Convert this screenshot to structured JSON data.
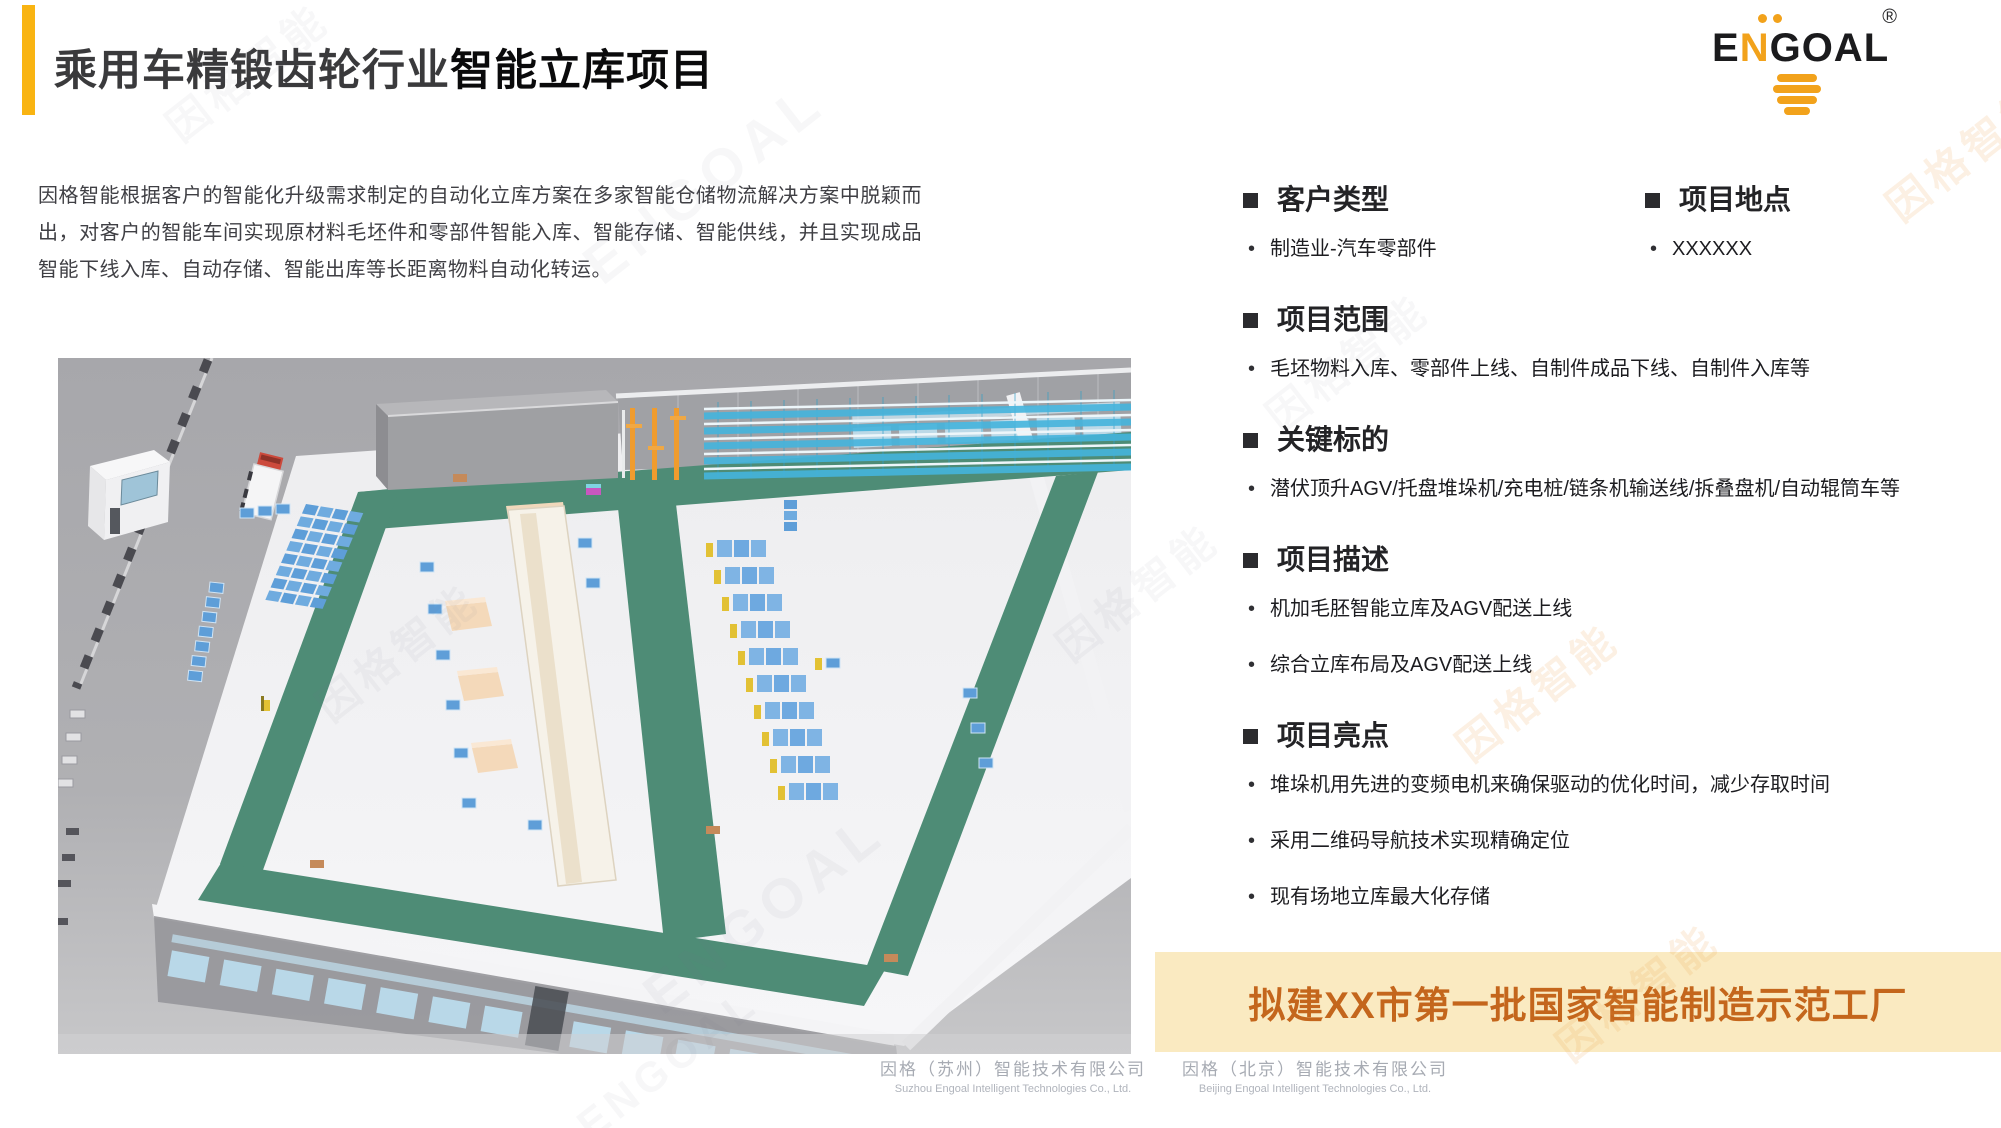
{
  "slide": {
    "title_part1": "乘用车精锻齿轮行业",
    "title_part2": "智能立库项目",
    "intro": "因格智能根据客户的智能化升级需求制定的自动化立库方案在多家智能仓储物流解决方案中脱颖而出，对客户的智能车间实现原材料毛坯件和零部件智能入库、智能存储、智能供线，并且实现成品智能下线入库、自动存储、智能出库等长距离物料自动化转运。"
  },
  "logo": {
    "e": "E",
    "n": "N",
    "goal": "GOAL",
    "registered": "®"
  },
  "sections": [
    {
      "title": "客户类型",
      "items": [
        "制造业-汽车零部件"
      ]
    },
    {
      "title": "项目地点",
      "items": [
        "XXXXXX"
      ]
    },
    {
      "title": "项目范围",
      "items": [
        "毛坯物料入库、零部件上线、自制件成品下线、自制件入库等"
      ]
    },
    {
      "title": "关键标的",
      "items": [
        "潜伏顶升AGV/托盘堆垛机/充电桩/链条机输送线/拆叠盘机/自动辊筒车等"
      ]
    },
    {
      "title": "项目描述",
      "items": [
        "机加毛胚智能立库及AGV配送上线",
        "综合立库布局及AGV配送上线"
      ]
    },
    {
      "title": "项目亮点",
      "items": [
        "堆垛机用先进的变频电机来确保驱动的优化时间，减少存取时间",
        "采用二维码导航技术实现精确定位",
        "现有场地立库最大化存储"
      ]
    }
  ],
  "banner": {
    "text": "拟建XX市第一批国家智能制造示范工厂",
    "bg_color": "#FAEAC1",
    "text_color": "#C4661C"
  },
  "footer": {
    "companies": [
      {
        "cn": "因格（苏州）智能技术有限公司",
        "en": "Suzhou Engoal Intelligent Technologies Co., Ltd."
      },
      {
        "cn": "因格（北京）智能技术有限公司",
        "en": "Beijing Engoal Intelligent Technologies Co., Ltd."
      }
    ]
  },
  "watermark": {
    "cn": "因格智能",
    "en": "ENGOAL"
  },
  "colors": {
    "accent_yellow": "#F9B412",
    "logo_orange": "#F2A21B",
    "banner_bg": "#FAEAC1",
    "banner_text": "#C4661C",
    "path_green": "#4E8C76",
    "rack_cyan": "#45B4DD",
    "crane_orange": "#F09C2E",
    "pallet_blue": "#5E9ED8",
    "floor_white": "#F2F2F4"
  }
}
